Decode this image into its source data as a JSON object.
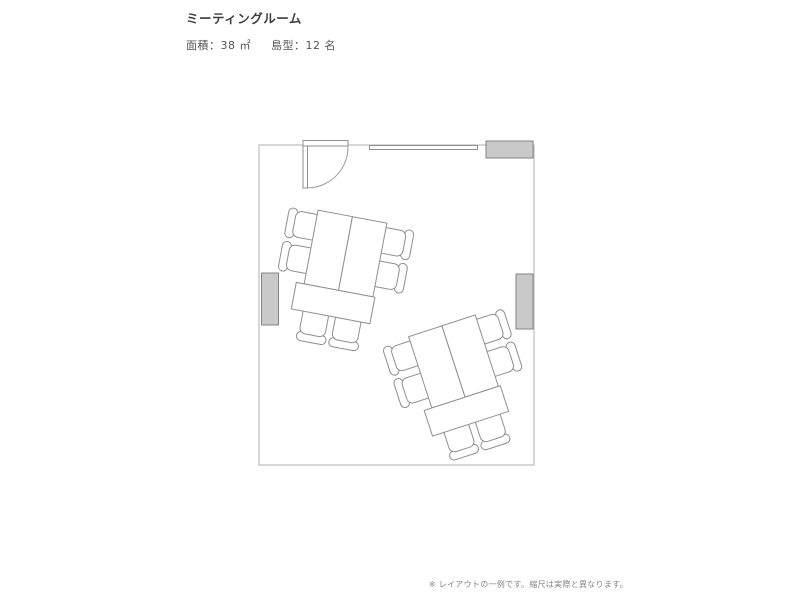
{
  "header": {
    "title": "ミーティングルーム",
    "area_label": "面積：38 ㎡",
    "layout_label": "島型：12 名"
  },
  "footer": {
    "note": "※ レイアウトの一例です。縮尺は実際と異なります。"
  },
  "floorplan": {
    "islands": 2,
    "chairs_total": 12,
    "fixtures": [
      "door-swing",
      "whiteboard",
      "cabinet-top-right",
      "cabinet-left",
      "cabinet-right"
    ]
  },
  "colors": {
    "cabinet_fill": "#c9c9c9",
    "cabinet_stroke": "#858585",
    "furniture_stroke": "#8f8f8f",
    "wall_stroke": "#b6b6b6",
    "title_text": "#3d3d3d",
    "spec_text": "#555555",
    "note_text": "#858585"
  }
}
